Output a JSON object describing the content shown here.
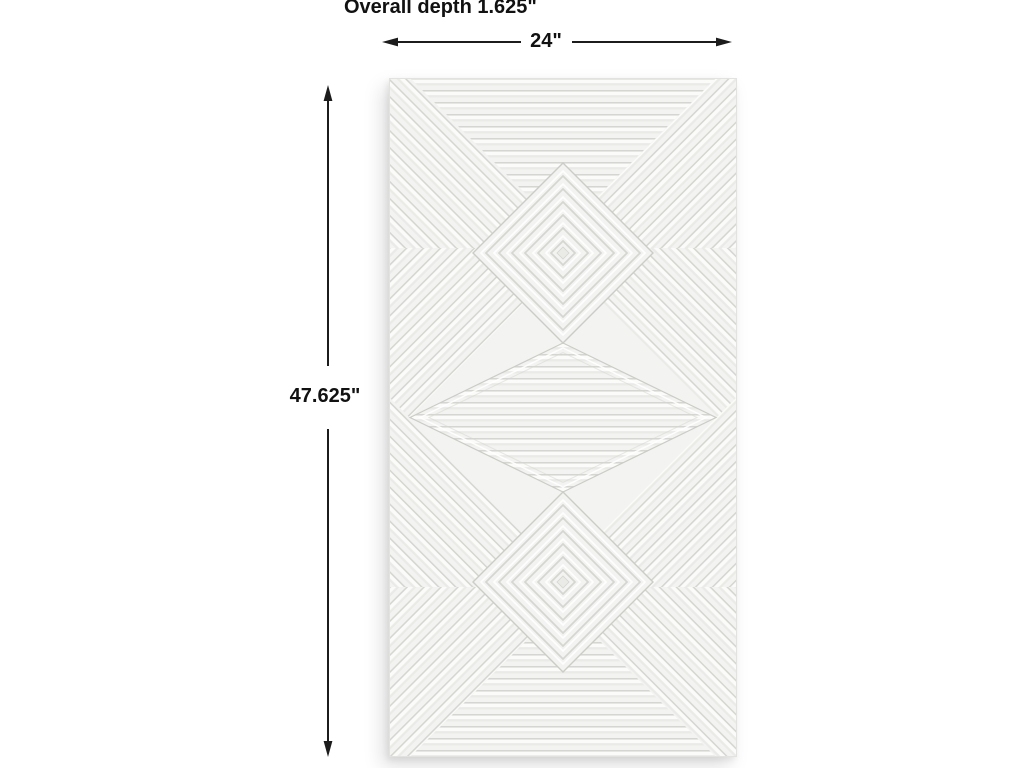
{
  "page": {
    "background": "#ffffff"
  },
  "annotations": {
    "depth_label": "Overall depth 1.625\"",
    "width_label": "24\"",
    "height_label": "47.625\"",
    "line_color": "#1c1c1c",
    "text_color": "#111111"
  },
  "panel": {
    "alt": "White carved wood wall panel with ridged geometric pattern: two concentric diamond medallions, a wide horizontal-striped center diamond, mitred diagonal-striped corners and horizontal-striped top and bottom triangles",
    "colors": {
      "base": "#f3f3f1",
      "hi": "#fbfbf9",
      "midtone": "#eaeae7",
      "groove": "#d5d5d1",
      "edge": "#cbcbc7",
      "border": "#e2e2df"
    }
  }
}
